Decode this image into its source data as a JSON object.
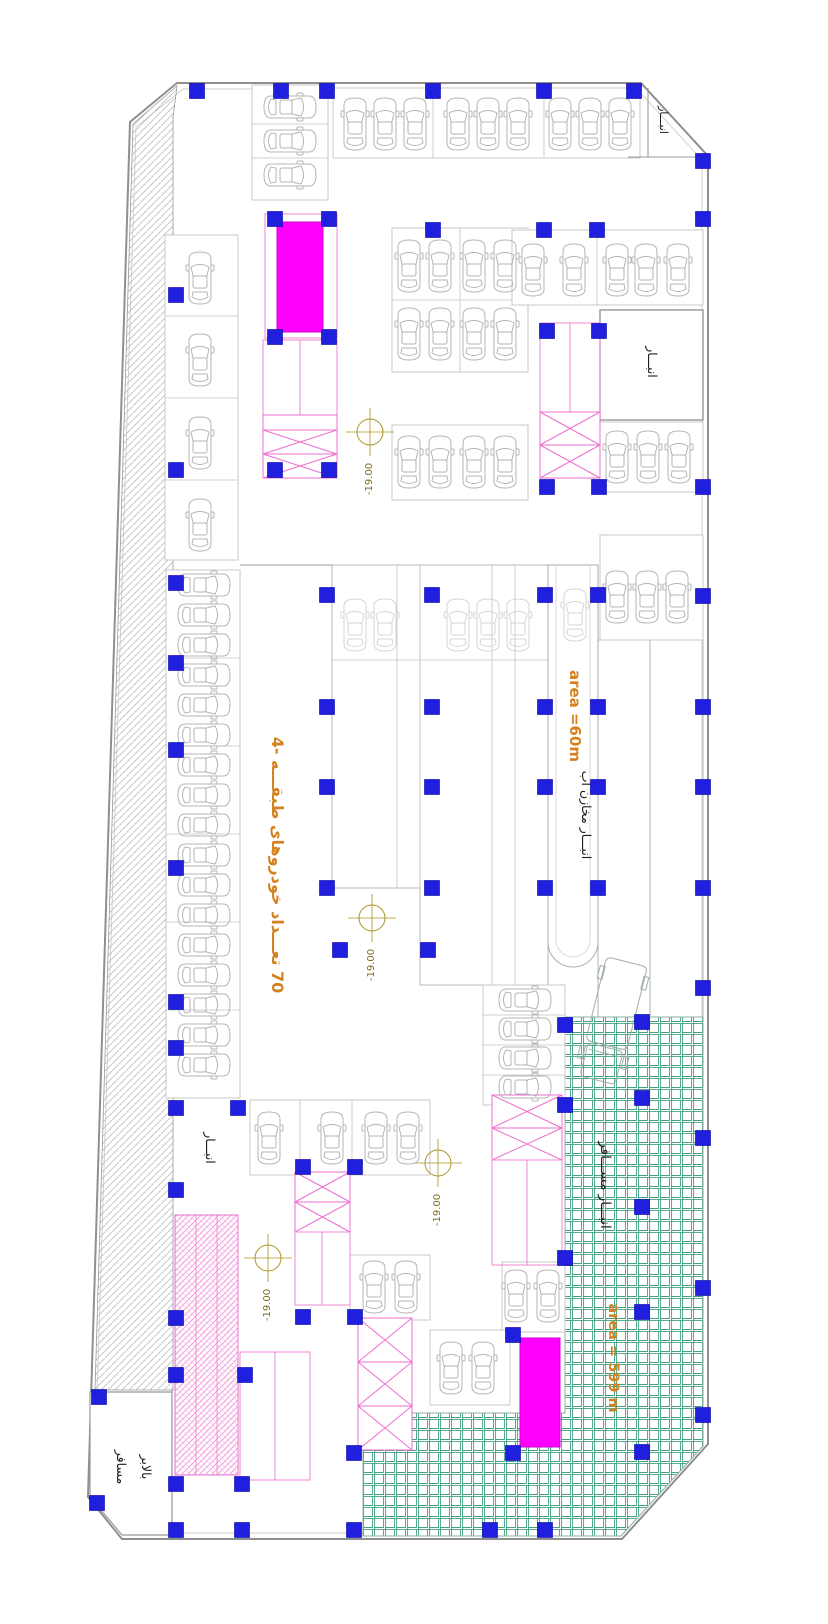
{
  "labels": {
    "storage_top_right": "انبـــار",
    "storage_right": "انبـــار",
    "storage_left": "انبـــار",
    "storage_green": "انبـــار  مســـافر",
    "water_tank_storage": "انبـــار مخازن آب",
    "area_60": "area =60m",
    "area_599": "area = 599 m",
    "car_count": "70 تعـــداد خودروهای طبقـــه  -4",
    "lift_word_1": "بالابر",
    "lift_word_2": "مسافر",
    "level": "-19.00"
  },
  "colors": {
    "column_blue": "#1f1fdd",
    "column_border": "#0000a8",
    "shaft_magenta": "#ff00ff",
    "stair_pink": "#ef87d3",
    "ramp_pink": "#f2a3dc",
    "green_grid": "#43a183",
    "hatch_gray": "#bcbcbc",
    "text_orange": "#d4821f",
    "level_olive": "#ab9422",
    "car_gray": "#b5b5b5",
    "wall_gray": "#8f8f8f"
  },
  "plan": {
    "columns": [
      [
        197,
        91
      ],
      [
        281,
        91
      ],
      [
        327,
        91
      ],
      [
        433,
        91
      ],
      [
        544,
        91
      ],
      [
        634,
        91
      ],
      [
        703,
        161
      ],
      [
        703,
        219
      ],
      [
        703,
        487
      ],
      [
        703,
        596
      ],
      [
        703,
        707
      ],
      [
        703,
        787
      ],
      [
        703,
        888
      ],
      [
        703,
        988
      ],
      [
        703,
        1138
      ],
      [
        703,
        1288
      ],
      [
        703,
        1415
      ],
      [
        275,
        219
      ],
      [
        329,
        219
      ],
      [
        275,
        337
      ],
      [
        329,
        337
      ],
      [
        275,
        470
      ],
      [
        329,
        470
      ],
      [
        433,
        230
      ],
      [
        544,
        230
      ],
      [
        597,
        230
      ],
      [
        547,
        331
      ],
      [
        599,
        331
      ],
      [
        547,
        487
      ],
      [
        599,
        487
      ],
      [
        176,
        295
      ],
      [
        176,
        470
      ],
      [
        176,
        583
      ],
      [
        176,
        663
      ],
      [
        176,
        750
      ],
      [
        176,
        868
      ],
      [
        176,
        1002
      ],
      [
        176,
        1048
      ],
      [
        176,
        1108
      ],
      [
        176,
        1190
      ],
      [
        176,
        1318
      ],
      [
        176,
        1375
      ],
      [
        176,
        1484
      ],
      [
        176,
        1530
      ],
      [
        238,
        1108
      ],
      [
        245,
        1375
      ],
      [
        242,
        1484
      ],
      [
        242,
        1530
      ],
      [
        97,
        1503
      ],
      [
        99,
        1397
      ],
      [
        327,
        595
      ],
      [
        432,
        595
      ],
      [
        545,
        595
      ],
      [
        598,
        595
      ],
      [
        327,
        707
      ],
      [
        432,
        707
      ],
      [
        545,
        707
      ],
      [
        598,
        707
      ],
      [
        327,
        787
      ],
      [
        432,
        787
      ],
      [
        545,
        787
      ],
      [
        598,
        787
      ],
      [
        327,
        888
      ],
      [
        432,
        888
      ],
      [
        545,
        888
      ],
      [
        598,
        888
      ],
      [
        340,
        950
      ],
      [
        428,
        950
      ],
      [
        565,
        1025
      ],
      [
        642,
        1022
      ],
      [
        565,
        1105
      ],
      [
        642,
        1098
      ],
      [
        642,
        1207
      ],
      [
        565,
        1258
      ],
      [
        642,
        1312
      ],
      [
        513,
        1335
      ],
      [
        513,
        1453
      ],
      [
        354,
        1453
      ],
      [
        354,
        1530
      ],
      [
        303,
        1167
      ],
      [
        355,
        1167
      ],
      [
        303,
        1317
      ],
      [
        355,
        1317
      ],
      [
        490,
        1530
      ],
      [
        545,
        1530
      ],
      [
        642,
        1452
      ]
    ],
    "cars": [
      [
        355,
        124,
        0,
        0
      ],
      [
        385,
        124,
        0,
        0
      ],
      [
        415,
        124,
        0,
        0
      ],
      [
        458,
        124,
        0,
        0
      ],
      [
        488,
        124,
        0,
        0
      ],
      [
        518,
        124,
        0,
        0
      ],
      [
        560,
        124,
        0,
        0
      ],
      [
        590,
        124,
        0,
        0
      ],
      [
        620,
        124,
        0,
        0
      ],
      [
        290,
        107,
        90,
        0
      ],
      [
        290,
        141,
        90,
        0
      ],
      [
        290,
        175,
        90,
        0
      ],
      [
        200,
        278,
        0,
        0
      ],
      [
        200,
        360,
        0,
        0
      ],
      [
        200,
        443,
        0,
        0
      ],
      [
        200,
        525,
        0,
        0
      ],
      [
        204,
        585,
        90,
        0
      ],
      [
        204,
        615,
        90,
        0
      ],
      [
        204,
        645,
        90,
        0
      ],
      [
        204,
        675,
        90,
        0
      ],
      [
        204,
        705,
        90,
        0
      ],
      [
        204,
        735,
        90,
        0
      ],
      [
        204,
        765,
        90,
        0
      ],
      [
        204,
        795,
        90,
        0
      ],
      [
        204,
        825,
        90,
        0
      ],
      [
        204,
        855,
        90,
        0
      ],
      [
        204,
        885,
        90,
        0
      ],
      [
        204,
        915,
        90,
        0
      ],
      [
        204,
        945,
        90,
        0
      ],
      [
        204,
        975,
        90,
        0
      ],
      [
        204,
        1005,
        90,
        0
      ],
      [
        204,
        1035,
        90,
        0
      ],
      [
        204,
        1065,
        90,
        0
      ],
      [
        409,
        266,
        0,
        0
      ],
      [
        440,
        266,
        0,
        0
      ],
      [
        474,
        266,
        0,
        0
      ],
      [
        505,
        266,
        0,
        0
      ],
      [
        409,
        334,
        0,
        0
      ],
      [
        440,
        334,
        0,
        0
      ],
      [
        474,
        334,
        0,
        0
      ],
      [
        505,
        334,
        0,
        0
      ],
      [
        409,
        462,
        0,
        0
      ],
      [
        440,
        462,
        0,
        0
      ],
      [
        474,
        462,
        0,
        0
      ],
      [
        505,
        462,
        0,
        0
      ],
      [
        533,
        270,
        0,
        0
      ],
      [
        574,
        270,
        0,
        0
      ],
      [
        617,
        270,
        0,
        0
      ],
      [
        646,
        270,
        0,
        0
      ],
      [
        678,
        270,
        0,
        0
      ],
      [
        617,
        457,
        0,
        0
      ],
      [
        648,
        457,
        0,
        0
      ],
      [
        679,
        457,
        0,
        0
      ],
      [
        617,
        597,
        0,
        0
      ],
      [
        647,
        597,
        0,
        0
      ],
      [
        677,
        597,
        0,
        0
      ],
      [
        355,
        625,
        0,
        1
      ],
      [
        385,
        625,
        0,
        1
      ],
      [
        458,
        625,
        0,
        1
      ],
      [
        488,
        625,
        0,
        1
      ],
      [
        518,
        625,
        0,
        1
      ],
      [
        575,
        615,
        0,
        1
      ],
      [
        269,
        1138,
        0,
        0
      ],
      [
        332,
        1138,
        0,
        0
      ],
      [
        376,
        1138,
        0,
        0
      ],
      [
        408,
        1138,
        0,
        0
      ],
      [
        374,
        1287,
        0,
        0
      ],
      [
        406,
        1287,
        0,
        0
      ],
      [
        451,
        1368,
        0,
        0
      ],
      [
        483,
        1368,
        0,
        0
      ],
      [
        516,
        1296,
        0,
        0
      ],
      [
        548,
        1296,
        0,
        0
      ],
      [
        525,
        1000,
        90,
        0
      ],
      [
        525,
        1029,
        90,
        0
      ],
      [
        525,
        1058,
        90,
        0
      ],
      [
        525,
        1087,
        90,
        0
      ]
    ],
    "level_markers": [
      [
        370,
        432
      ],
      [
        372,
        918
      ],
      [
        438,
        1163
      ],
      [
        268,
        1258
      ]
    ]
  }
}
